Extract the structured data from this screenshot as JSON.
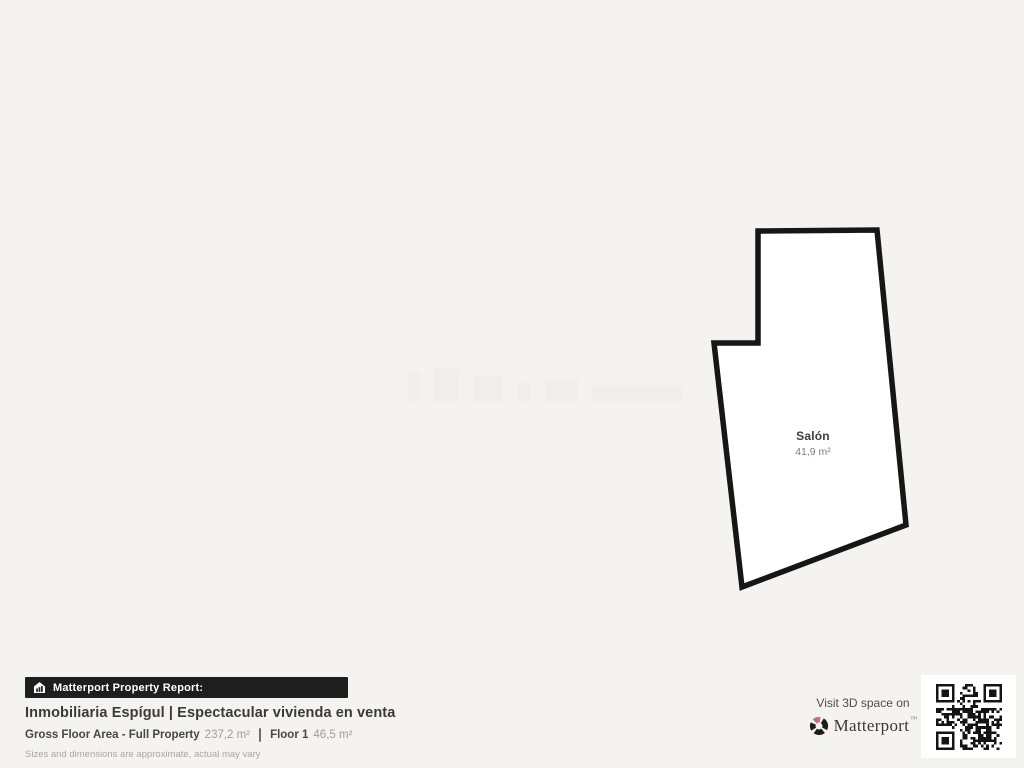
{
  "page": {
    "background_color": "#f4f3f0"
  },
  "floorplan": {
    "points": "758,231 877,230 906,525 742,587 714,343 758,343",
    "stroke_color": "#161616",
    "fill_color": "#ffffff",
    "room": {
      "name": "Salón",
      "area": "41,9 m²"
    }
  },
  "footer": {
    "report_badge": {
      "icon": "house-chart-icon",
      "label": "Matterport Property Report:"
    },
    "title": "Inmobiliaria Espígul | Espectacular vivienda en venta",
    "stats": [
      {
        "label": "Gross Floor Area - Full Property",
        "value": "237,2 m²"
      },
      {
        "label": "Floor 1",
        "value": "46,5 m²"
      }
    ],
    "disclaimer": "Sizes and dimensions are approximate, actual may vary"
  },
  "cta": {
    "visit_text": "Visit 3D space on",
    "brand": "Matterport",
    "trademark": "™",
    "brand_color": "#3a3a3a",
    "logo_accent_color": "#c96d8d",
    "qr": "qr-code"
  }
}
